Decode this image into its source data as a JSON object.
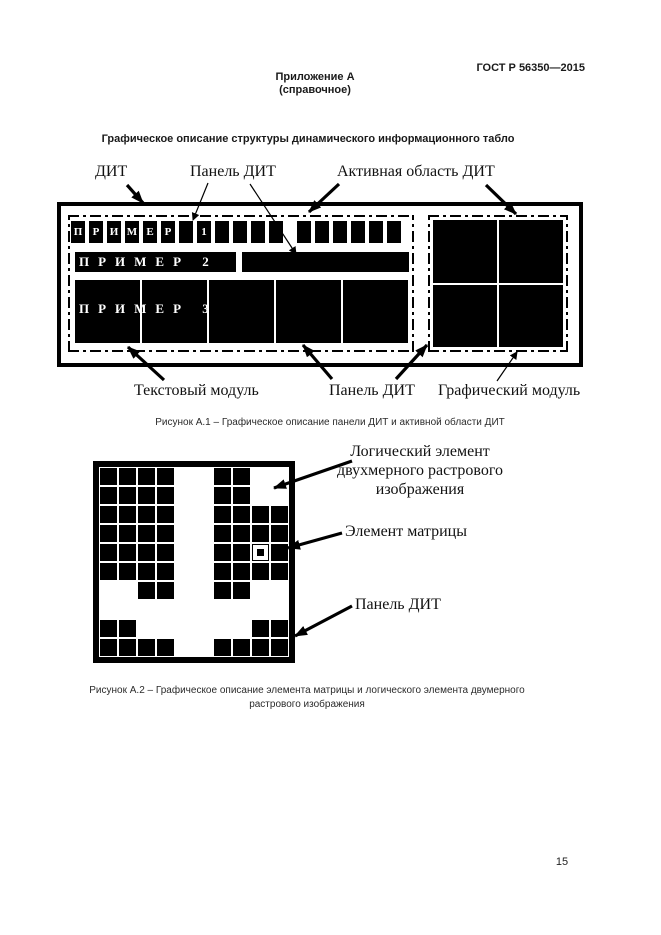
{
  "page": {
    "standard": "ГОСТ Р 56350—2015",
    "appendix_title": "Приложение А",
    "appendix_subtitle": "(справочное)",
    "section_title": "Графическое описание структуры динамического информационного табло",
    "page_number": "15"
  },
  "figure_a1": {
    "labels": {
      "dit": "ДИТ",
      "panel_top": "Панель ДИТ",
      "active_area": "Активная область ДИТ",
      "text_module": "Текстовый модуль",
      "panel_bottom": "Панель ДИТ",
      "graphic_module": "Графический модуль"
    },
    "display": {
      "row1_cells": [
        "П",
        "Р",
        "И",
        "М",
        "Е",
        "Р",
        "",
        "1",
        "",
        "",
        "",
        ""
      ],
      "row1_cells_right": [
        "",
        "",
        "",
        "",
        "",
        ""
      ],
      "row2_text": "ПРИМЕР 2",
      "row3_text": "ПРИМЕР 3",
      "row3_segments": 5
    },
    "caption": "Рисунок А.1 – Графическое описание панели ДИТ и активной области ДИТ"
  },
  "figure_a2": {
    "labels": {
      "logical_element_lines": [
        "Логический элемент",
        "двухмерного растрового",
        "изображения"
      ],
      "matrix_element": "Элемент матрицы",
      "panel": "Панель ДИТ"
    },
    "matrix": {
      "legend": "1=чёрная ячейка, 0=белая ячейка, 2=выделенный элемент матрицы",
      "rows": [
        "1111001100",
        "1111001100",
        "1111001111",
        "1111001111",
        "1111001121",
        "1111001111",
        "0011001100",
        "0000000000",
        "1100000011",
        "1111001111"
      ]
    },
    "caption_lines": [
      "Рисунок А.2 – Графическое описание элемента матрицы и логического элемента двумерного",
      "растрового изображения"
    ]
  }
}
